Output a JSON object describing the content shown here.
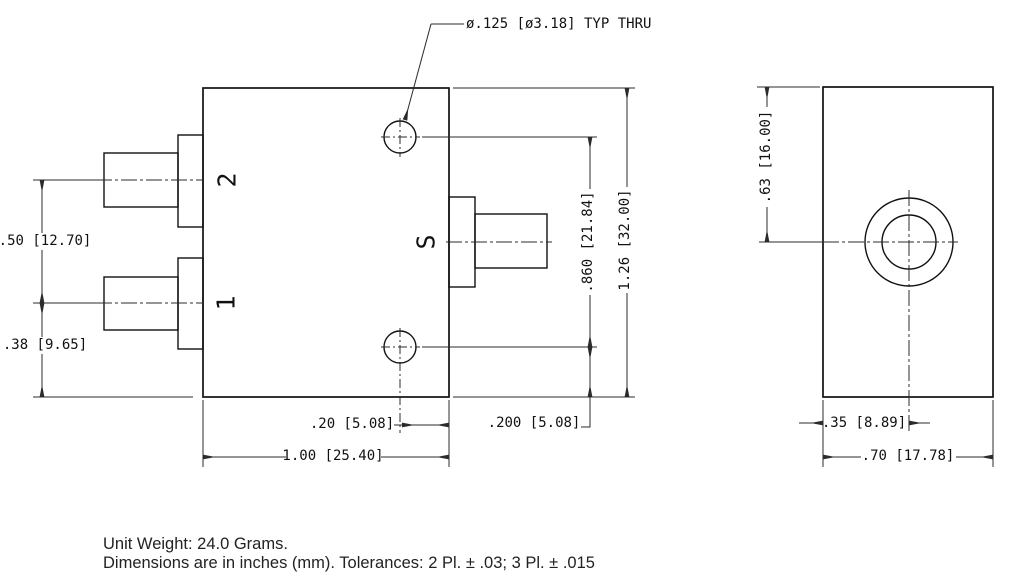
{
  "drawing": {
    "callout_hole": "ø.125 [ø3.18] TYP THRU",
    "front": {
      "label_port2": "2",
      "label_port1": "1",
      "label_port_s": "S",
      "dim_port_spacing": ".50 [12.70]",
      "dim_port1_to_base": ".38 [9.65]",
      "dim_hole_spacing": ".860 [21.84]",
      "dim_overall_height": "1.26 [32.00]",
      "dim_hole_to_right_edge": ".20 [5.08]",
      "dim_hole_to_base": ".200 [5.08]",
      "dim_overall_width": "1.00 [25.40]"
    },
    "side": {
      "dim_bore_from_top": ".63 [16.00]",
      "dim_bore_from_left": ".35 [8.89]",
      "dim_overall_width": ".70 [17.78]"
    },
    "notes": {
      "line1": "Unit Weight: 24.0 Grams.",
      "line2": "Dimensions are in inches (mm). Tolerances: 2 Pl. ± .03; 3 Pl. ± .015"
    },
    "colors": {
      "line": "#111111",
      "background": "#ffffff"
    }
  }
}
